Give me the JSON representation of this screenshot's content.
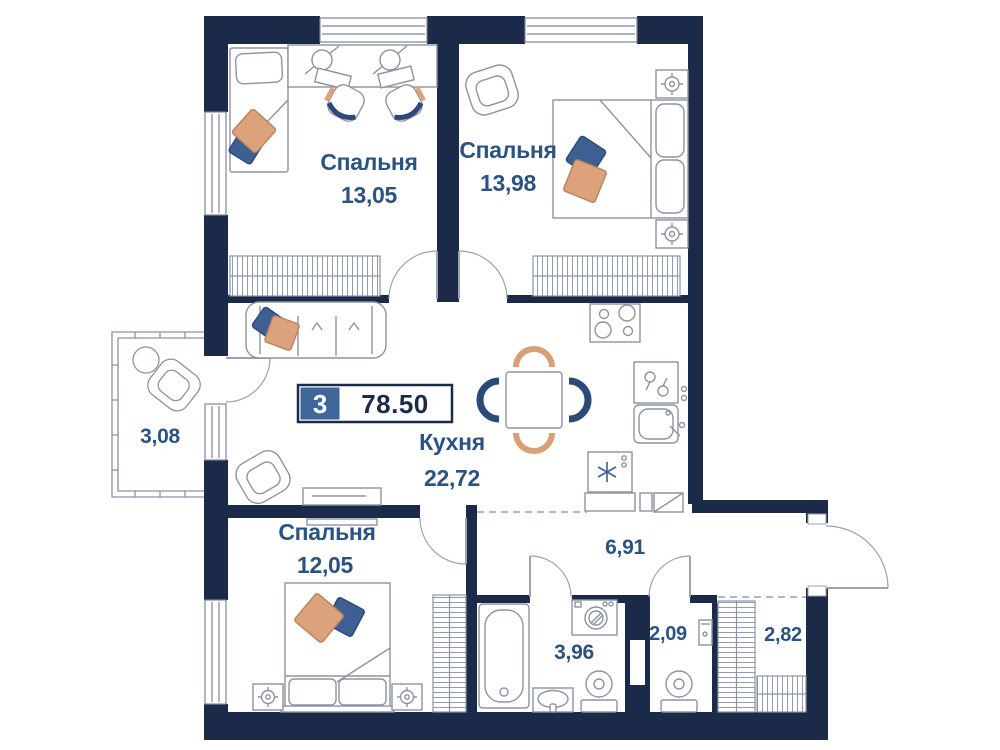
{
  "plan": {
    "badge": {
      "rooms_count": "3",
      "total_area": "78.50"
    },
    "rooms": [
      {
        "id": "bedroom-1",
        "name": "Спальня",
        "area": "13,05"
      },
      {
        "id": "bedroom-2",
        "name": "Спальня",
        "area": "13,98"
      },
      {
        "id": "kitchen",
        "name": "Кухня",
        "area": "22,72"
      },
      {
        "id": "balcony",
        "name": "",
        "area": "3,08"
      },
      {
        "id": "bedroom-3",
        "name": "Спальня",
        "area": "12,05"
      },
      {
        "id": "hallway",
        "name": "",
        "area": "6,91"
      },
      {
        "id": "bathroom",
        "name": "",
        "area": "3,96"
      },
      {
        "id": "wc",
        "name": "",
        "area": "2,09"
      },
      {
        "id": "storage",
        "name": "",
        "area": "2,82"
      }
    ],
    "colors": {
      "wall": "#1c2a4a",
      "label_blue": "#2b5382",
      "badge_blue": "#3f669b",
      "accent_orange": "#d9a077",
      "accent_navy": "#3d5f94",
      "furniture_gray": "#8d93a0"
    }
  }
}
